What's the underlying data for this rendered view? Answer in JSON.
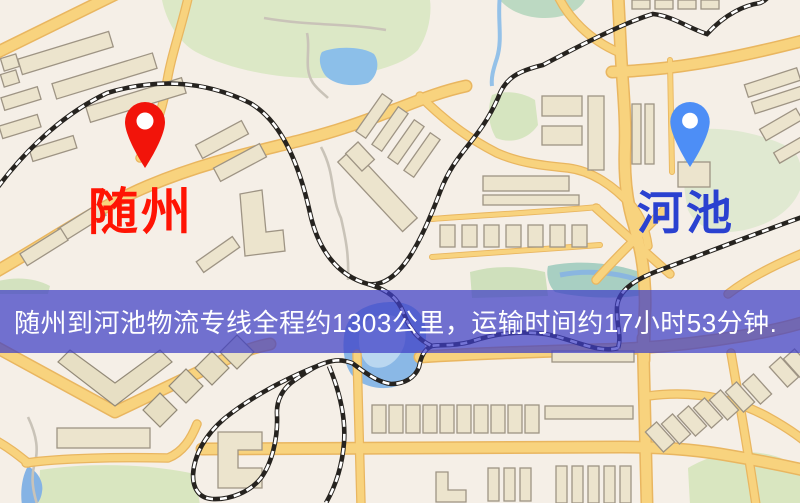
{
  "banner": {
    "text": "随州到河池物流专线全程约1303公里，运输时间约17小时53分钟.",
    "background_css": "rgba(62,62,198,0.72)",
    "text_color": "#ffffff"
  },
  "markers": {
    "origin": {
      "label": "随州",
      "label_color": "#ff1404",
      "pin_color": "#f2140a"
    },
    "destination": {
      "label": "河池",
      "label_color": "#2a41d0",
      "pin_color": "#4d8ef6"
    }
  },
  "route": {
    "origin_city": "随州",
    "destination_city": "河池",
    "distance_km": "1303",
    "duration": "17小时53分钟"
  },
  "map_colors": {
    "background": "#f5efe7",
    "road": "#f8d37e",
    "park": "#dce8c6",
    "water": "#8ab8e6",
    "railway": "#26231f"
  }
}
